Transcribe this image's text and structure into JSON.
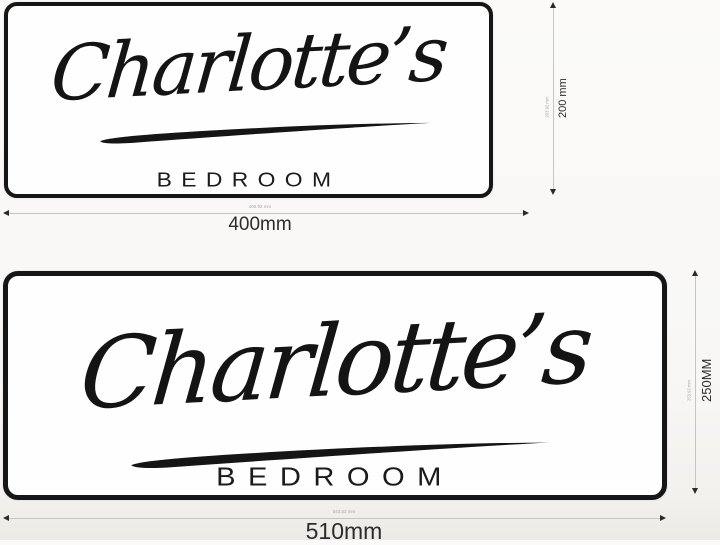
{
  "signs": [
    {
      "name_script": "Charlotte’s",
      "subtitle": "BEDROOM",
      "width_label": "400mm",
      "width_micro_label": "405.92 mm",
      "height_label": "200 mm",
      "height_micro_label": "203.92 mm"
    },
    {
      "name_script": "Charlotte’s",
      "subtitle": "BEDROOM",
      "width_label": "510mm",
      "width_micro_label": "543.52 mm",
      "height_label": "250MM",
      "height_micro_label": "253.92 mm"
    }
  ],
  "colors": {
    "ink": "#141414",
    "sign_background": "#fefefe",
    "page_background": "#f8f7f5",
    "dimension_line": "#c6c5c2",
    "dimension_text": "#2c2c2c",
    "micro_text": "#a8a6a2"
  }
}
